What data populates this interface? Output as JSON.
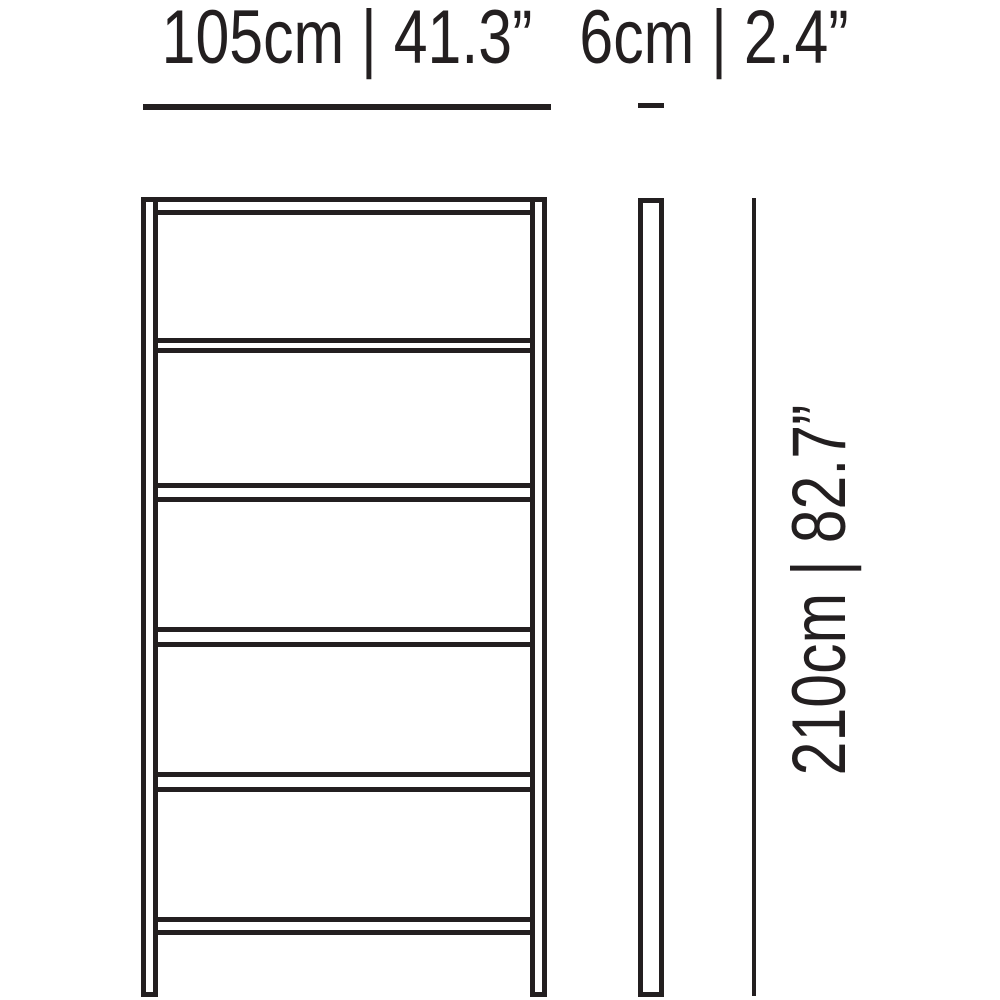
{
  "diagram": {
    "kind": "furniture-dimension-drawing",
    "shelf_count": 5,
    "labels": {
      "width": "105cm | 41.3”",
      "depth": "6cm | 2.4”",
      "height": "210cm | 82.7”"
    },
    "values": {
      "width_cm": 105,
      "width_in": 41.3,
      "depth_cm": 6,
      "depth_in": 2.4,
      "height_cm": 210,
      "height_in": 82.7
    },
    "colors": {
      "line": "#231f20",
      "background": "#ffffff"
    }
  }
}
